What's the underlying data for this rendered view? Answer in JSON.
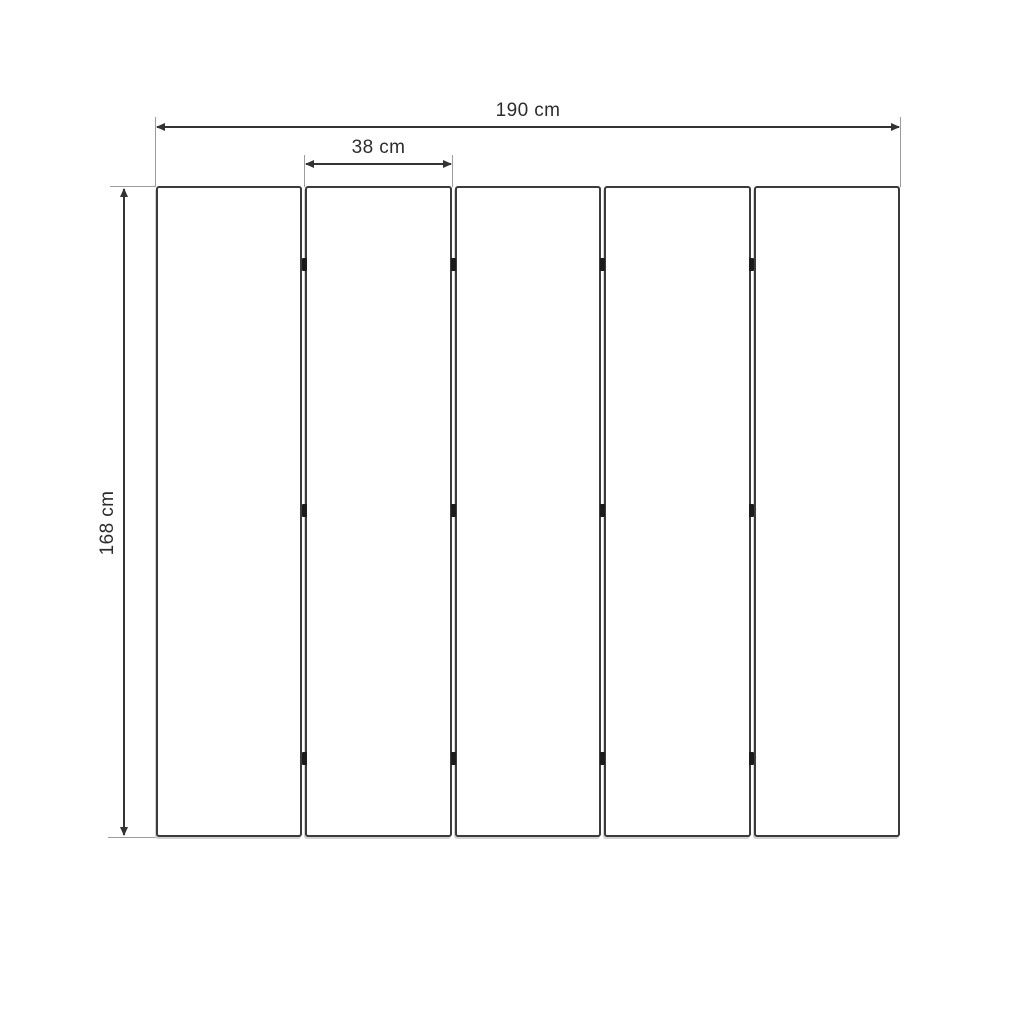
{
  "diagram": {
    "panel_count": 5,
    "gap_count": 4,
    "hinges_per_gap": 3
  },
  "dimension_labels": {
    "total_width": "190 cm",
    "panel_width": "38 cm",
    "height": "168 cm"
  },
  "colors": {
    "background": "#ffffff",
    "panel_outline": "#3b3b3b",
    "panel_fill": "#ffffff",
    "dimension_line": "#333333",
    "extension_line": "#9c9c9c",
    "hinge": "#1b1b1b",
    "label_text": "#2d2d2d"
  }
}
